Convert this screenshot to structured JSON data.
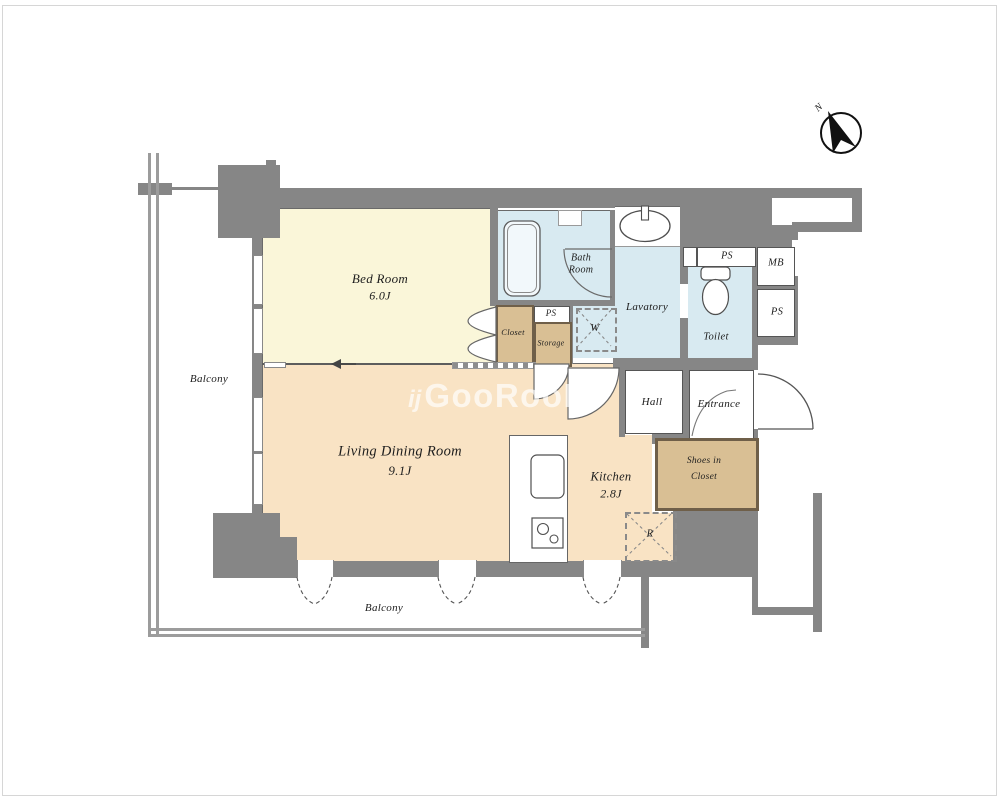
{
  "watermark": {
    "icon": "ij",
    "text": "GooRooM"
  },
  "compass": {
    "north": "N"
  },
  "rooms": {
    "bedroom": {
      "name": "Bed Room",
      "area": "6.0J"
    },
    "living_dining": {
      "name": "Living Dining Room",
      "area": "9.1J"
    },
    "kitchen": {
      "name": "Kitchen",
      "area": "2.8J"
    },
    "bath": {
      "line1": "Bath",
      "line2": "Room"
    },
    "lavatory": {
      "name": "Lavatory"
    },
    "toilet": {
      "name": "Toilet"
    },
    "hall": {
      "name": "Hall"
    },
    "entrance": {
      "name": "Entrance"
    },
    "closet": {
      "name": "Closet"
    },
    "storage": {
      "name": "Storage"
    },
    "shoes_in_closet": {
      "line1": "Shoes in",
      "line2": "Closet"
    },
    "balcony_left": {
      "name": "Balcony"
    },
    "balcony_bottom": {
      "name": "Balcony"
    }
  },
  "utilities": {
    "ps_middle": "PS",
    "ps_toilet": "PS",
    "ps_right": "PS",
    "mb": "MB",
    "washing_machine": "W",
    "refrigerator": "R"
  },
  "colors": {
    "wall": "#868686",
    "bedroom_floor": "#faf6d9",
    "living_floor": "#f9e3c4",
    "wet_area_floor": "#d8eaf1",
    "closet_floor": "#d9bf94",
    "fixture_line": "#555555"
  }
}
